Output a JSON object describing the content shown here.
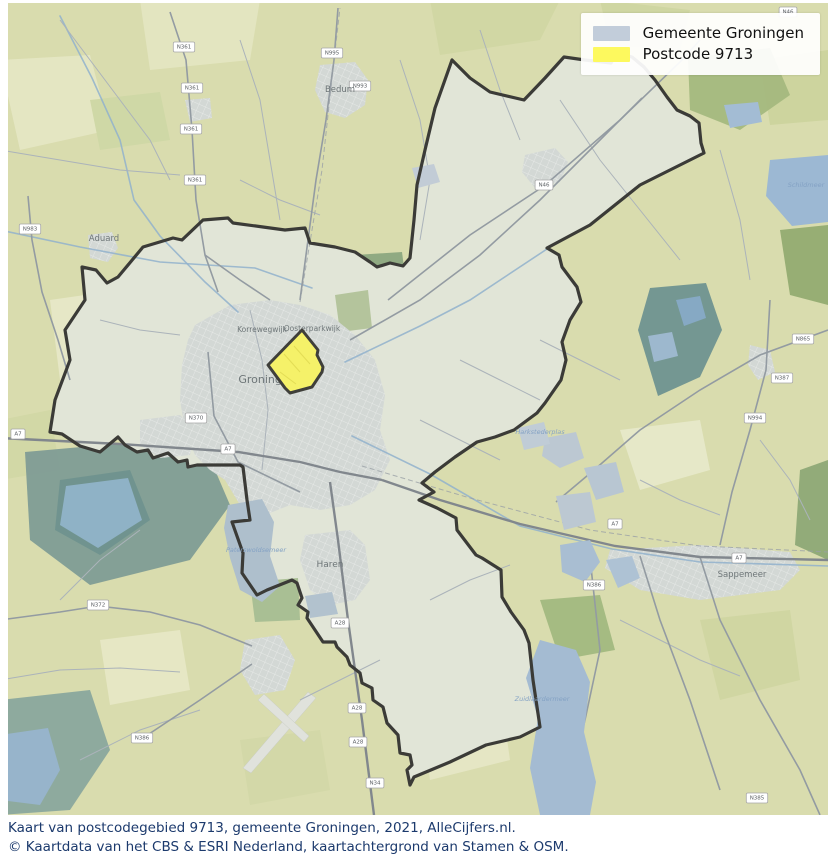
{
  "legend": {
    "items": [
      {
        "label": "Gemeente Groningen",
        "color": "#c2cdda"
      },
      {
        "label": "Postcode 9713",
        "color": "#fdf95e"
      }
    ]
  },
  "caption": {
    "line1": "Kaart van postcodegebied 9713, gemeente Groningen, 2021, AlleCijfers.nl.",
    "line2": "© Kaartdata van het CBS & ESRI Nederland, kaartachtergrond van Stamen & OSM."
  },
  "map": {
    "colors": {
      "base": "#d9dcae",
      "municipality_fill": "#e1e5d7",
      "city_fill": "#d3d8d5",
      "boundary": "#3b3b37",
      "postcode_fill": "#f5f169",
      "postcode_stroke": "#3f3f3a",
      "road_minor": "#abb3ba",
      "road_main": "#939ba2",
      "highway": "#81878d",
      "railway": "#9aa0a6",
      "canal": "#90b1cd",
      "water_label": "#84a2c4",
      "town_label": "#6e7678",
      "shield_border": "#a8a8a8",
      "shield_text": "#5d6165",
      "runway": "#e0e2dc"
    },
    "municipality_polygon": "50,432 62,434 80,446 100,452 118,437 125,445 137,452 148,450 153,458 168,453 178,462 187,460 188,467 197,465 240,465 243,467 247,500 250,520 232,522 243,553 242,573 257,595 267,590 292,580 297,583 302,598 298,605 308,612 307,618 313,627 323,642 335,642 337,647 347,657 350,665 360,673 362,683 372,688 373,700 383,707 387,723 398,735 400,753 410,755 412,765 407,770 410,785 414,777 450,762 486,745 520,737 540,727 533,680 529,643 524,630 511,612 502,597 501,570 482,558 476,555 457,530 456,518 437,508 419,500 434,492 422,483 435,472 455,457 477,442 495,437 514,430 537,413 545,403 561,380 566,360 562,342 570,320 581,302 577,287 562,267 559,255 547,248 590,225 640,185 704,153 701,143 699,123 690,116 677,110 667,97 655,80 644,67 632,57 617,53 611,63 585,60 564,57 545,78 524,100 490,92 470,78 452,60 435,108 425,150 417,185 414,220 410,258 403,266 390,263 377,267 370,262 355,252 335,247 310,243 305,228 285,230 263,227 233,223 228,218 203,220 182,240 173,238 143,247 118,277 107,283 96,270 82,267 85,300 65,330 70,360 55,400",
    "postcode_polygon": "302,330 318,350 317,355 323,367 322,372 312,387 290,393 285,388 268,365",
    "postcode_streets": [
      "284,354 300,372",
      "294,346 310,364",
      "280,372 296,384"
    ],
    "fields": [
      {
        "p": "140,0 260,0 250,60 150,70",
        "c": "#e3e5c0"
      },
      {
        "p": "0,60 90,55 110,130 20,150",
        "c": "#e4e6c2"
      },
      {
        "p": "430,0 560,0 540,40 440,55",
        "c": "#d1d7a4"
      },
      {
        "p": "600,0 690,10 680,50 610,45",
        "c": "#cfd6a2"
      },
      {
        "p": "50,300 120,290 130,360 60,380",
        "c": "#e6e7c6"
      },
      {
        "p": "0,420 50,410 60,470 0,480",
        "c": "#d2d8a6"
      },
      {
        "p": "620,430 700,420 710,470 640,490",
        "c": "#e6e8c8"
      },
      {
        "p": "700,620 790,610 800,680 720,700",
        "c": "#d0d6a2"
      },
      {
        "p": "420,700 500,690 510,760 430,780",
        "c": "#e5e6c4"
      },
      {
        "p": "100,640 180,630 190,690 110,705",
        "c": "#e6e7c4"
      },
      {
        "p": "240,740 320,730 330,790 250,805",
        "c": "#d3d8a8"
      },
      {
        "p": "760,60 828,50 828,120 770,125",
        "c": "#cdd49e"
      },
      {
        "p": "90,100 160,92 170,140 100,150",
        "c": "#cfd8a6"
      }
    ],
    "forests_outer": [
      {
        "p": "25,452 160,440 215,470 230,505 190,560 90,585 30,540",
        "c": "#7f9c95"
      },
      {
        "p": "60,480 130,470 150,520 100,555 55,530",
        "c": "#6f928e"
      },
      {
        "p": "0,700 90,690 110,750 70,810 0,815",
        "c": "#8aa79d"
      },
      {
        "p": "650,288 706,283 722,330 700,377 658,396 638,330",
        "c": "#6f9290"
      },
      {
        "p": "688,58 770,48 790,95 740,130 690,110",
        "c": "#a4b87e"
      },
      {
        "p": "780,230 828,225 828,305 790,295",
        "c": "#93ab71"
      },
      {
        "p": "800,470 828,460 828,560 795,545",
        "c": "#8ea876"
      },
      {
        "p": "355,255 402,252 408,298 362,300",
        "c": "#8ca67f"
      },
      {
        "p": "540,600 600,595 615,650 560,660",
        "c": "#a2b87f"
      }
    ],
    "greens_inner": [
      {
        "p": "250,582 298,578 300,620 255,622",
        "c": "#a9bf94"
      },
      {
        "p": "335,295 368,290 372,328 340,332",
        "c": "#b4c49c"
      }
    ],
    "urban": [
      {
        "p": "195,325 230,305 270,300 300,305 330,315 355,335 375,360 385,395 380,430 390,460 375,490 350,505 320,510 290,505 265,515 240,505 225,480 210,470 195,455 185,430 180,400 182,365 188,340",
        "city": true
      },
      {
        "p": "140,420 180,415 195,430 190,455 160,458 140,445",
        "city": true
      },
      {
        "p": "305,535 350,530 365,545 370,580 355,600 330,605 310,590 300,560",
        "city": true
      },
      {
        "p": "320,65 355,62 368,80 365,105 345,118 325,112 315,90",
        "city": false
      },
      {
        "p": "88,235 112,232 118,248 108,262 90,258",
        "city": false
      },
      {
        "p": "525,155 555,148 568,162 560,182 535,188 522,172",
        "city": true
      },
      {
        "p": "610,550 700,545 790,552 800,570 780,590 700,600 640,590 605,568",
        "city": false
      },
      {
        "p": "185,100 210,98 212,118 190,122",
        "city": false
      },
      {
        "p": "750,345 770,350 775,372 758,380 748,365",
        "city": false
      },
      {
        "p": "245,640 280,635 295,660 285,690 255,695 240,670",
        "city": false
      }
    ],
    "runways": [
      "243,768 251,773 316,698 308,692",
      "258,700 304,742 309,736 264,694"
    ],
    "roads_highway": [
      "0,438 120,444 238,452 300,462 340,472 382,480",
      "382,480 440,500 520,524 615,546 700,557 828,560",
      "330,482 338,540 348,620 362,720 374,815"
    ],
    "roads_main": [
      "170,12 186,60 192,130 196,200 205,255 218,292",
      "338,8 334,60 326,120 316,180 308,240 300,300",
      "388,300 470,235 544,186 620,120 680,62 700,40",
      "350,340 420,300 480,255 540,200 600,140 642,98",
      "828,330 760,355 700,390 640,430 594,470 556,502",
      "770,300 766,370 750,430 732,492 720,545",
      "590,558 600,650 585,720 570,780 562,815",
      "0,620 60,612 98,606 150,612 200,625 252,646",
      "140,740 200,700 252,664",
      "28,196 32,240 42,292 58,340 70,380",
      "700,557 720,620 760,700 800,770 820,815",
      "640,556 660,620 690,700 720,790",
      "205,255 240,280 270,300",
      "208,352 214,416 238,462 300,492"
    ],
    "roads_minor": [
      "60,20 90,60 120,100 150,140 170,180",
      "0,150 60,160 120,170 180,175",
      "240,40 260,100 270,160 280,220",
      "400,60 420,120 430,180 420,240",
      "480,30 500,90 520,140",
      "560,100 600,160 640,210 680,260",
      "720,150 740,220 750,280",
      "60,600 100,560 140,530",
      "0,680 60,670 120,668 180,672",
      "80,760 140,730 200,710",
      "300,700 340,680 380,660",
      "430,600 470,580 510,565",
      "620,620 660,640 700,660 740,676",
      "760,440 790,480 810,520",
      "460,360 500,380 540,400",
      "420,420 460,440 500,460",
      "240,180 280,200 320,215",
      "100,320 140,330 180,335",
      "640,480 680,500 720,515",
      "540,340 580,360 620,380",
      "250,310 262,360 268,410 262,470"
    ],
    "railways": [
      "300,302 322,170 334,60 340,8",
      "362,466 470,498 590,530 700,546 828,552"
    ],
    "canals": [
      "60,16 92,78 120,140 134,200 160,236 205,282 238,312",
      "0,230 80,247 160,262 255,268 312,288",
      "345,362 420,326 470,300 547,249",
      "352,436 430,474 520,526 612,549 700,562 828,566"
    ],
    "lakes_outer": [
      {
        "p": "770,160 828,155 828,222 792,226 766,196",
        "c": "#9cb8d3"
      },
      {
        "p": "724,105 758,102 762,122 730,128",
        "c": "#a3bcd4"
      },
      {
        "p": "540,640 576,650 590,682 584,732 596,782 590,815 540,815 530,768 538,718 526,678",
        "c": "#a4bbd2"
      },
      {
        "p": "560,545 590,540 600,562 585,582 562,572",
        "c": "#a9bed2"
      },
      {
        "p": "606,560 632,556 640,578 618,588",
        "c": "#aec2d4"
      },
      {
        "p": "0,735 48,728 60,770 40,805 0,800",
        "c": "#97b4cb"
      },
      {
        "p": "66,486 128,478 142,520 98,548 60,525",
        "c": "#8fb2c6"
      },
      {
        "p": "676,300 700,296 706,318 684,326",
        "c": "#86a9c4"
      },
      {
        "p": "648,336 672,332 678,356 654,362",
        "c": "#9db8ce"
      }
    ],
    "lakes_inner": [
      {
        "p": "228,505 262,499 274,522 270,556 280,586 262,602 240,590 230,558 224,528",
        "c": "#aebfcc"
      },
      {
        "p": "545,438 576,432 584,458 560,468 542,456",
        "c": "#bcc8d2"
      },
      {
        "p": "584,468 616,462 624,492 596,500",
        "c": "#b8c6d2"
      },
      {
        "p": "556,496 590,492 596,522 564,530",
        "c": "#bcc8d2"
      },
      {
        "p": "518,428 544,422 550,444 524,450",
        "c": "#c0ccd6"
      },
      {
        "p": "412,168 434,164 440,182 418,188",
        "c": "#c2ccd6"
      },
      {
        "p": "305,596 332,592 338,614 310,618",
        "c": "#b2c2ce"
      }
    ],
    "road_shields": [
      {
        "t": "N361",
        "x": 184,
        "y": 47
      },
      {
        "t": "N361",
        "x": 192,
        "y": 88
      },
      {
        "t": "N361",
        "x": 191,
        "y": 129
      },
      {
        "t": "N361",
        "x": 195,
        "y": 180
      },
      {
        "t": "N995",
        "x": 332,
        "y": 53
      },
      {
        "t": "N993",
        "x": 360,
        "y": 86
      },
      {
        "t": "N983",
        "x": 30,
        "y": 229
      },
      {
        "t": "N46",
        "x": 544,
        "y": 185
      },
      {
        "t": "N46",
        "x": 788,
        "y": 12
      },
      {
        "t": "A7",
        "x": 18,
        "y": 434
      },
      {
        "t": "A7",
        "x": 228,
        "y": 449
      },
      {
        "t": "A7",
        "x": 615,
        "y": 524
      },
      {
        "t": "A7",
        "x": 739,
        "y": 558
      },
      {
        "t": "N370",
        "x": 196,
        "y": 418
      },
      {
        "t": "A28",
        "x": 340,
        "y": 623
      },
      {
        "t": "A28",
        "x": 357,
        "y": 708
      },
      {
        "t": "A28",
        "x": 358,
        "y": 742
      },
      {
        "t": "N34",
        "x": 375,
        "y": 783
      },
      {
        "t": "N372",
        "x": 98,
        "y": 605
      },
      {
        "t": "N386",
        "x": 142,
        "y": 738
      },
      {
        "t": "N386",
        "x": 594,
        "y": 585
      },
      {
        "t": "N865",
        "x": 803,
        "y": 339
      },
      {
        "t": "N387",
        "x": 782,
        "y": 378
      },
      {
        "t": "N994",
        "x": 755,
        "y": 418
      },
      {
        "t": "N385",
        "x": 757,
        "y": 798
      }
    ],
    "town_labels": [
      {
        "t": "Bedum",
        "x": 340,
        "y": 92,
        "s": 8.5
      },
      {
        "t": "Aduard",
        "x": 104,
        "y": 241,
        "s": 8.5
      },
      {
        "t": "Korrewegwijk",
        "x": 262,
        "y": 332,
        "s": 7.5
      },
      {
        "t": "Oosterparkwijk",
        "x": 312,
        "y": 331,
        "s": 7.5
      },
      {
        "t": "Groningen",
        "x": 267,
        "y": 383,
        "s": 11
      },
      {
        "t": "Haren",
        "x": 330,
        "y": 567,
        "s": 9
      },
      {
        "t": "Sappemeer",
        "x": 742,
        "y": 577,
        "s": 8.5
      }
    ],
    "water_labels": [
      {
        "t": "Schildmeer",
        "x": 806,
        "y": 187
      },
      {
        "t": "Zuidlaardermeer",
        "x": 542,
        "y": 701
      },
      {
        "t": "Harkstederplas",
        "x": 540,
        "y": 434
      },
      {
        "t": "Paterswoldsemeer",
        "x": 256,
        "y": 552
      }
    ]
  }
}
